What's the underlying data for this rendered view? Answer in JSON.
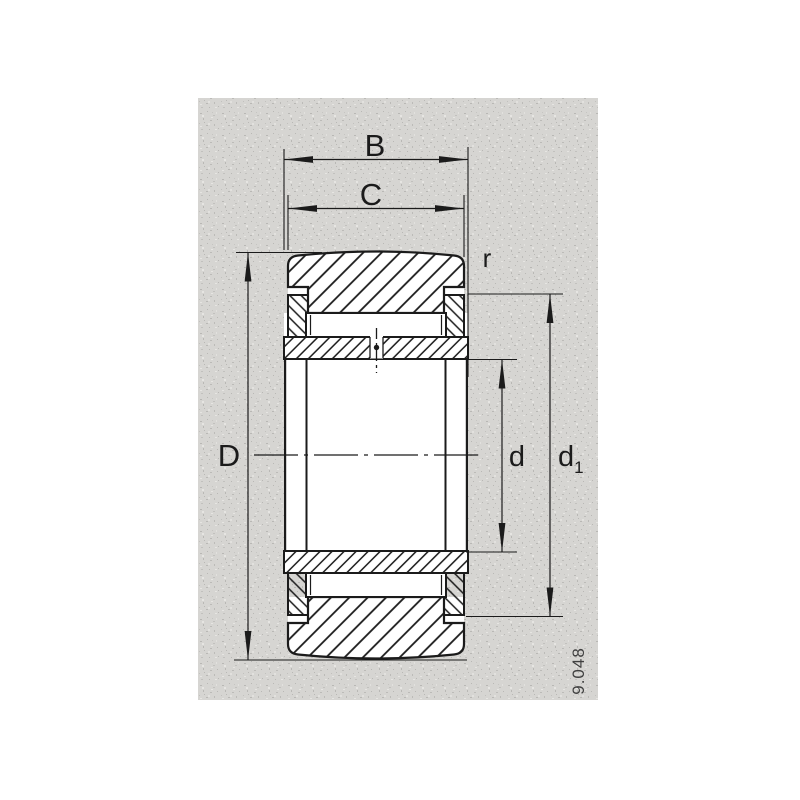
{
  "figure": {
    "number": "9.048"
  },
  "drawing": {
    "description_labels": {
      "B": "B",
      "C": "C",
      "D": "D",
      "d": "d",
      "d1_base": "d",
      "d1_sub": "1",
      "r": "r"
    }
  },
  "colors": {
    "line": "#1b1b1b",
    "panel": "#d6d5d2",
    "page": "#ffffff",
    "figure_number": "#3f3f3f"
  }
}
